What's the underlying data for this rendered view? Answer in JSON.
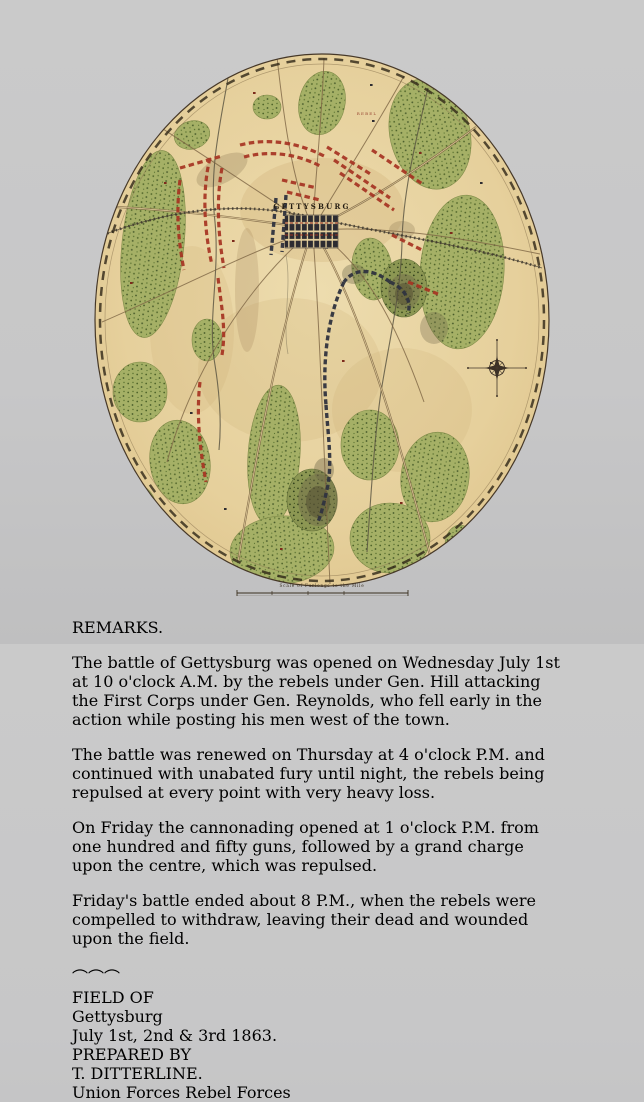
{
  "poster": {
    "map": {
      "town_label": "GETTYSBURG",
      "rebel_label": "REBEL",
      "scale_label": "Scale of Furlongs to the Mile",
      "colors": {
        "paper": "#e7d3a1",
        "forest": "#a5b066",
        "rebel_forces": "#a63322",
        "union_forces": "#30333f",
        "border": "#463828"
      }
    },
    "remarks": {
      "title": "REMARKS.",
      "paragraphs": [
        "The battle of Gettysburg was opened on Wednesday July 1st at 10 o'clock A.M. by the rebels under Gen. Hill attacking the First Corps under Gen. Reynolds, who fell early in the action while posting his men west of the town.",
        "The battle was renewed on Thursday at 4 o'clock P.M. and continued with unabated fury until night, the rebels being repulsed at every point with very heavy loss.",
        "On Friday the cannonading opened at 1 o'clock P.M. from one hundred and fifty guns, followed by a grand charge upon the centre, which was repulsed.",
        "Friday's battle ended about 8 P.M., when the rebels were compelled to withdraw, leaving their dead and wounded upon the field."
      ]
    },
    "cartouche": {
      "field_of": "FIELD OF",
      "title": "Gettysburg",
      "dates": "July 1st, 2nd & 3rd 1863.",
      "prepared_by": "PREPARED BY",
      "author": "T. DITTERLINE.",
      "legend": [
        {
          "label": "Union Forces",
          "color": "#2b3a63"
        },
        {
          "label": "Rebel Forces",
          "color": "#a63322"
        }
      ]
    }
  }
}
